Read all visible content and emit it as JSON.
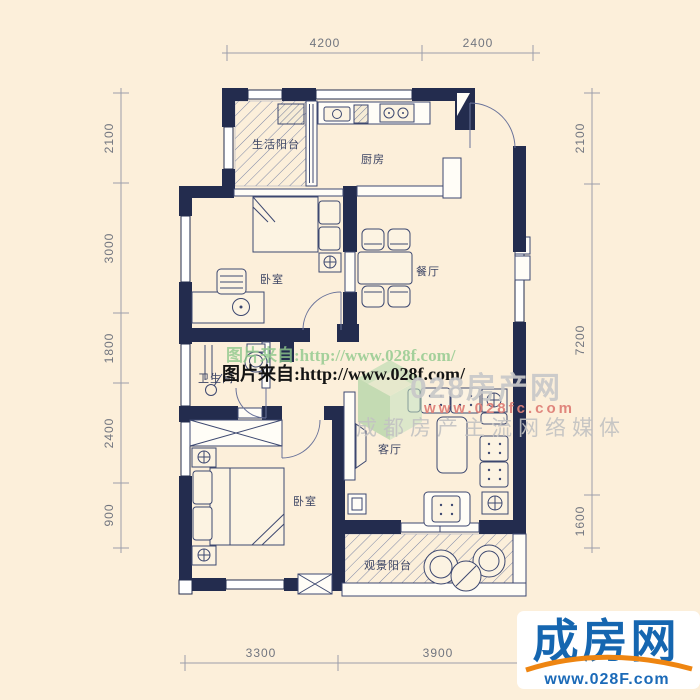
{
  "colors": {
    "background": "#fcefda",
    "wall": "#232c4e",
    "line": "#3d4870",
    "dimension_text": "#71757f",
    "watermark_green": "#8fc98c",
    "watermark_gray": "#c9c9c9",
    "watermark_red": "#df8078",
    "logo_blue": "#1566b0",
    "logo_orange": "#ee8511"
  },
  "rooms": {
    "service_balcony": "生活阳台",
    "kitchen": "厨房",
    "bedroom_top": "卧室",
    "dining": "餐厅",
    "bathroom": "卫生间",
    "living": "客厅",
    "bedroom_bottom": "卧室",
    "view_balcony": "观景阳台"
  },
  "dimensions": {
    "top": [
      "4200",
      "2400"
    ],
    "left": [
      "2100",
      "3000",
      "1800",
      "2400",
      "900"
    ],
    "right": [
      "2100",
      "7200",
      "1600"
    ],
    "bottom": [
      "3300",
      "3900"
    ]
  },
  "watermark": {
    "source_line_shadow": "图片来自:http://www.028f.com/",
    "source_line": "图片来自:http://www.028f.com/",
    "brand": "028房产网",
    "brand_url": "www.028fc.com",
    "tagline": "成都房产主流网络媒体"
  },
  "logo": {
    "name": "成房网",
    "url": "www.028F.com"
  }
}
